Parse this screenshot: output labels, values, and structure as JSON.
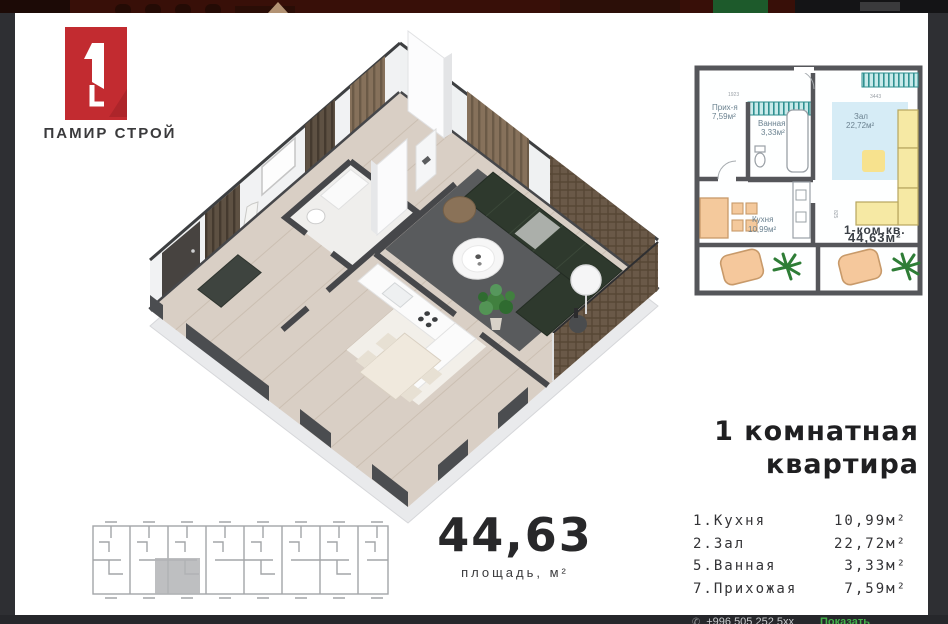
{
  "logo": {
    "brand": "ПАМИР СТРОЙ",
    "badge_color": "#c22b30"
  },
  "heading": {
    "line1": "1 комнатная",
    "line2": "квартира"
  },
  "area": {
    "value": "44,63",
    "label": "площадь, м²"
  },
  "rooms": [
    {
      "name": "1.Кухня",
      "area": "10,99м²"
    },
    {
      "name": "2.Зал",
      "area": "22,72м²"
    },
    {
      "name": "5.Ванная",
      "area": "3,33м²"
    },
    {
      "name": "7.Прихожая",
      "area": "7,59м²"
    }
  ],
  "plan2d": {
    "hall": {
      "name": "Прих-я",
      "area": "7,59м²"
    },
    "bath": {
      "name": "Ванная",
      "area": "3,33м²"
    },
    "living": {
      "name": "Зал",
      "area": "22,72м²"
    },
    "kitchen": {
      "name": "Кухня",
      "area": "10,99м²"
    },
    "unit": {
      "name": "1-ком.кв.",
      "area": "44,63м²"
    },
    "dims": {
      "left": "1923",
      "right": "3443",
      "side": "825"
    },
    "colors": {
      "wall": "#55565a",
      "window_teal": "#35a7a3",
      "rug_blue": "#d6ecf6",
      "furniture_yellow": "#f6e9a4",
      "furniture_orange": "#f4c99c",
      "plant_green": "#3f9a4d"
    }
  },
  "footer": {
    "phone": "+996 505 252 5xx",
    "action": "Показать",
    "action_color": "#43b04a"
  }
}
